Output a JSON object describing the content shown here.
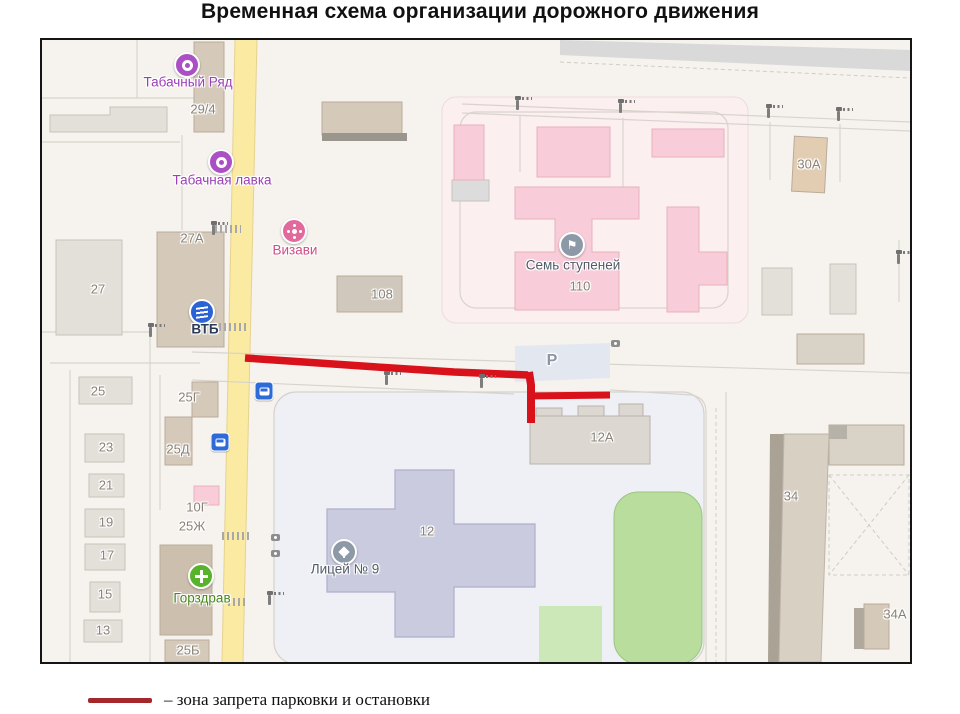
{
  "title": "Временная схема организации дорожного движения",
  "legend": {
    "label": "– зона запрета парковки и остановки",
    "line_color": "#a3272b"
  },
  "map": {
    "labels": {
      "tobacco_row": "Табачный Ряд",
      "b29_4": "29/4",
      "tobacco_shop": "Табачная лавка",
      "b27a": "27А",
      "vizavi": "Визави",
      "b27": "27",
      "vtb": "ВТБ",
      "b108": "108",
      "seven_steps": "Семь ступеней",
      "b110": "110",
      "b30a": "30А",
      "b25": "25",
      "b25g": "25Г",
      "b23": "23",
      "b25d": "25Д",
      "b21": "21",
      "b19": "19",
      "b10g": "10Г",
      "b25zh": "25Ж",
      "b17": "17",
      "b15": "15",
      "gorzdrav": "Горздрав",
      "b13": "13",
      "b25b": "25Б",
      "b12": "12",
      "lyceum": "Лицей № 9",
      "b12a": "12А",
      "parking": "Р",
      "b34": "34",
      "b34a": "34А"
    },
    "icons": [
      "tobacco-row-poi-icon",
      "tobacco-shop-poi-icon",
      "vizavi-flower-icon",
      "vtb-bank-icon",
      "seven-steps-flag-icon",
      "lyceum-school-icon",
      "gorzdrav-pharmacy-icon",
      "bus-stop-icon",
      "street-lamp-icon",
      "camera-icon"
    ],
    "colors": {
      "no_stopping_line": "#d8111b",
      "road_yellow": "#fbeaa2",
      "building_pink": "#f8ccd8",
      "building_gray": "#e3e0da",
      "building_tan": "#d5c9ba",
      "school_lavender": "#cbcbdf",
      "green_area": "#b9dd9c",
      "parking_fill": "#e3e8f0"
    }
  }
}
